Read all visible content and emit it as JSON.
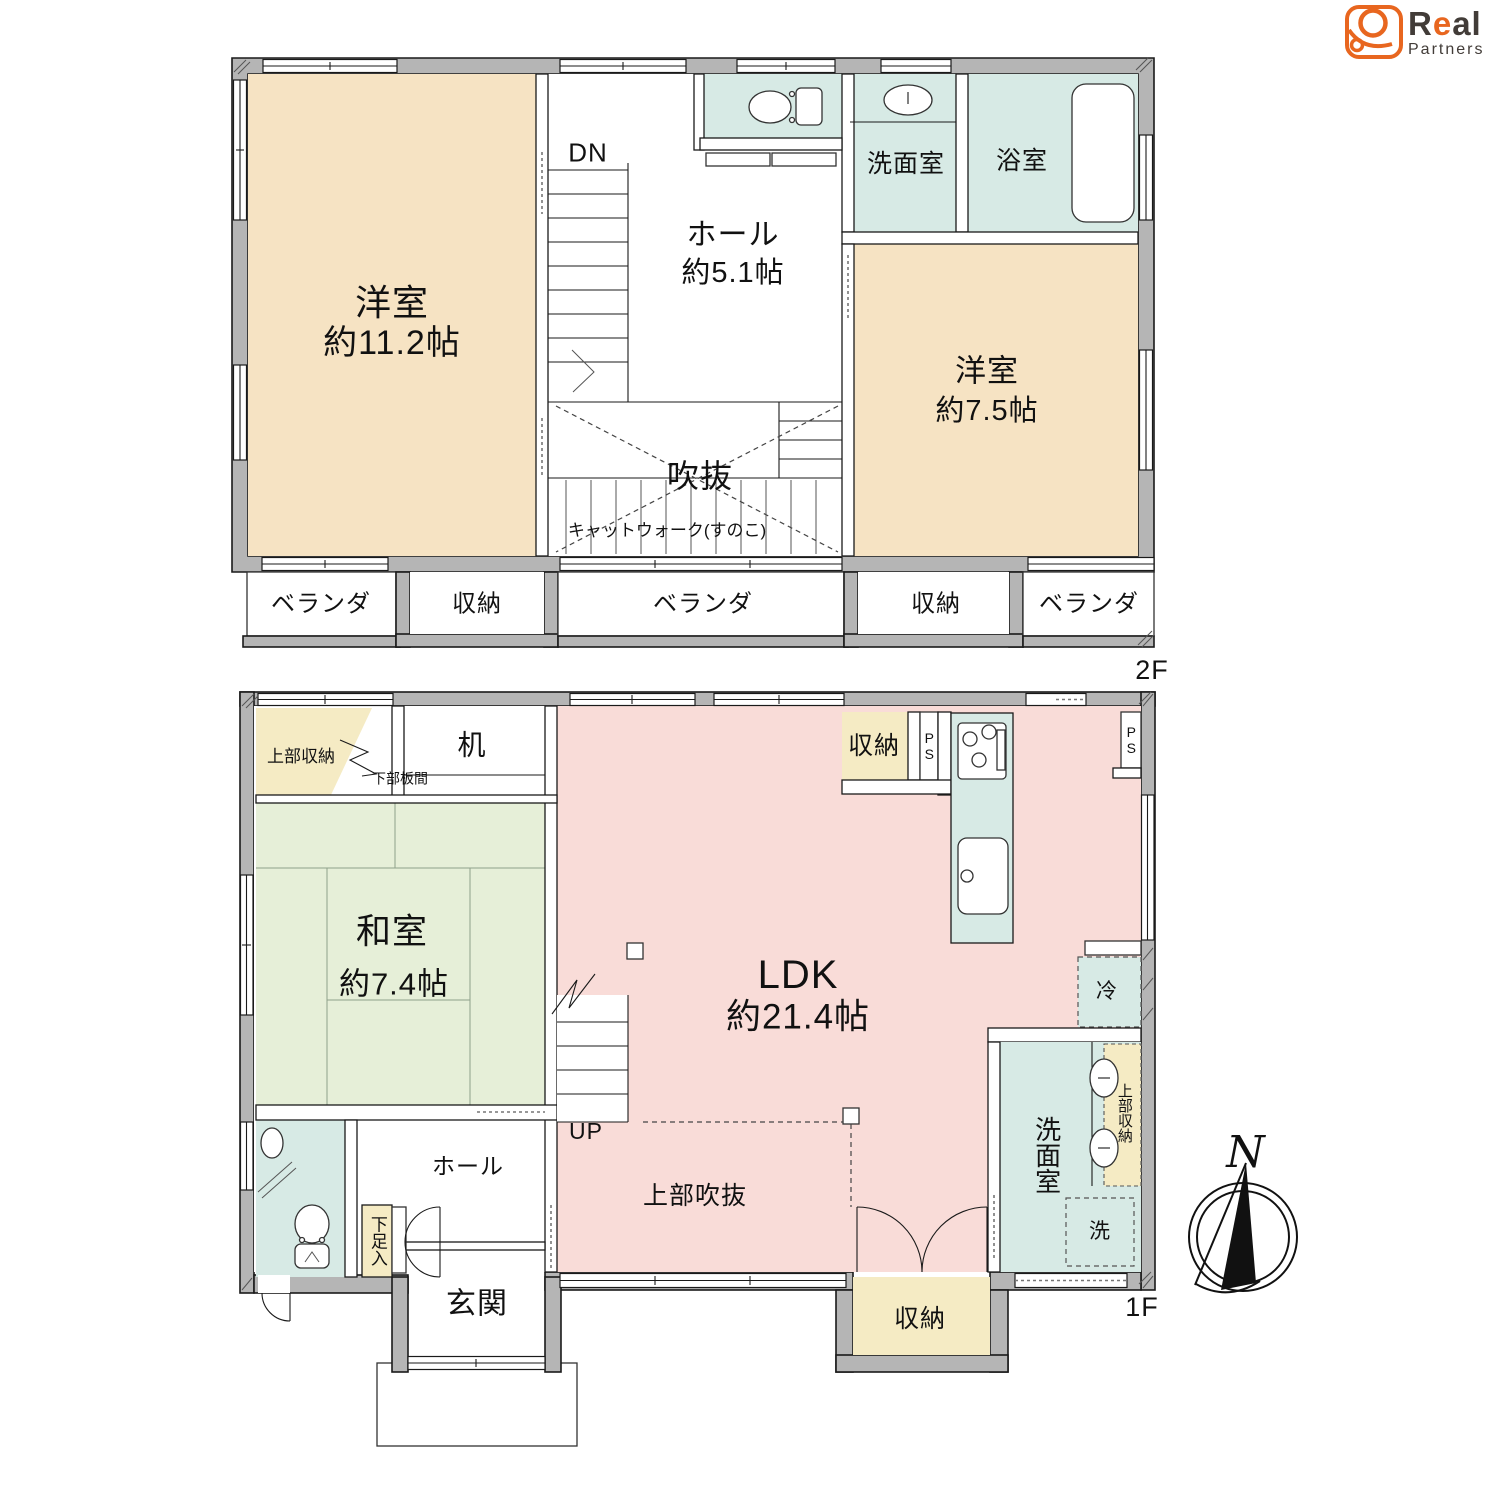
{
  "colors": {
    "accent_orange": "#e8661f",
    "logo_dark": "#423c38",
    "wall_gray": "#b5b5b5",
    "western_room_beige": "#f6e3c3",
    "sanitary_blue": "#d7eae5",
    "tatami_green": "#e6efd8",
    "ldk_pink": "#f9dcd8",
    "storage_cream": "#f5ebc4"
  },
  "logo": {
    "r": "R",
    "e": "e",
    "al": "al",
    "partners": "Partners"
  },
  "compass": {
    "north": "N"
  },
  "floor2": {
    "floor_label": "2F",
    "yoshitsu_large": {
      "name": "洋室",
      "size": "約11.2帖"
    },
    "hall": {
      "name": "ホール",
      "size": "約5.1帖"
    },
    "yoshitsu_small": {
      "name": "洋室",
      "size": "約7.5帖"
    },
    "senmenshitsu": "洗面室",
    "yokushitsu": "浴室",
    "fukinuke": "吹抜",
    "catwalk": "キャットウォーク(すのこ)",
    "stairs_down": "DN",
    "veranda_left": "ベランダ",
    "storage_left": "収納",
    "veranda_center": "ベランダ",
    "storage_right": "収納",
    "veranda_right": "ベランダ"
  },
  "floor1": {
    "floor_label": "1F",
    "upper_storage": "上部収納",
    "lower_board": "下部板間",
    "desk": "机",
    "washitsu": {
      "name": "和室",
      "size": "約7.4帖"
    },
    "ldk": {
      "name": "LDK",
      "size": "約21.4帖"
    },
    "kitchen_storage": "収納",
    "ps_kitchen": "PS",
    "ps_right": "PS",
    "fridge": "冷",
    "senmenshitsu": "洗面室",
    "upper_storage2": "上部収納",
    "washer": "洗",
    "hall": "ホール",
    "shoe_box": "下足入",
    "genkan": "玄関",
    "stairs_up": "UP",
    "upper_void": "上部吹抜",
    "storage_bottom": "収納"
  }
}
